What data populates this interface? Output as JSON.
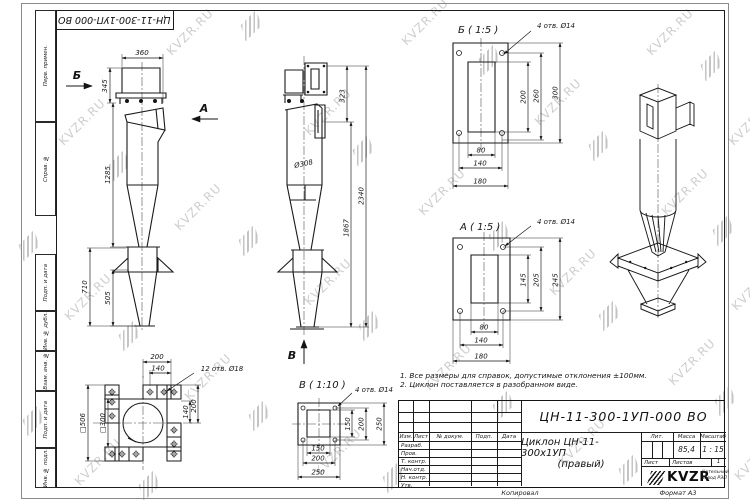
{
  "watermark": {
    "text": "KVZR.RU"
  },
  "sheet": {
    "top_doc_number": "ЦН-11-300-1УП-000 ВО",
    "margin_labels": [
      "Перв. примен.",
      "Справ. №",
      "Подп. и дата",
      "Инв. № дубл.",
      "Взам. инв. №",
      "Подп. и дата",
      "Инв. № подл."
    ]
  },
  "views": {
    "front": {
      "arrow_b": "Б",
      "arrow_a": "А",
      "dims": {
        "top_width": "360",
        "inlet_height": "345",
        "body_height": "1285",
        "bunker_height": "710",
        "cone_height": "505"
      }
    },
    "side": {
      "arrow_v": "В",
      "dims": {
        "flange_offset": "323",
        "total_height": "2340",
        "lower_height": "1867",
        "body_diameter": "Ø308"
      }
    },
    "detail_b": {
      "title": "Б ( 1:5 )",
      "holes": "4 отв. Ø14",
      "dims": {
        "v1": "200",
        "v2": "260",
        "v3": "300",
        "h1": "80",
        "h2": "140",
        "h3": "180"
      }
    },
    "detail_a": {
      "title": "А ( 1:5 )",
      "holes": "4 отв. Ø14",
      "dims": {
        "v1": "145",
        "v2": "205",
        "v3": "245",
        "h1": "80",
        "h2": "140",
        "h3": "180"
      }
    },
    "detail_v": {
      "title": "В ( 1:10 )",
      "holes": "4 отв. Ø14",
      "dims": {
        "v1": "150",
        "v2": "200",
        "v3": "250",
        "h1": "150",
        "h2": "200",
        "h3": "250"
      }
    },
    "support": {
      "holes": "12 отв. Ø18",
      "dims": {
        "t1": "200",
        "t2": "140",
        "l1": "□506",
        "l2": "□300",
        "r1": "140",
        "r2": "200"
      }
    }
  },
  "notes": {
    "line1": "1. Все размеры для справок, допустимые отклонения ±100мм.",
    "line2": "2. Циклон поставляется в разобранном виде."
  },
  "title_block": {
    "doc_number": "ЦН-11-300-1УП-000 ВО",
    "product_title": "Циклон ЦН-11-300х1УП",
    "product_subtitle": "(правый)",
    "col_izm": "Изм.",
    "col_list": "Лист",
    "col_doc": "№ докум.",
    "col_podp": "Подп.",
    "col_data": "Дата",
    "row_razrab": "Разраб.",
    "row_prov": "Пров.",
    "row_tkontr": "Т. контр.",
    "row_nachotd": "Нач.отд.",
    "row_nkontr": "Н. контр.",
    "row_utv": "Утв.",
    "lit_label": "Лит.",
    "mass_label": "Масса",
    "scale_label": "Масштаб",
    "mass_value": "85,4",
    "scale_value": "1 : 15",
    "sheet_label": "Лист",
    "sheets_label": "Листов",
    "sheets_value": "1",
    "logo_text": "KVZR",
    "company_line1": "Котельный",
    "company_line2": "завод РЭП",
    "footer_copy": "Копировал",
    "footer_format": "Формат А3"
  }
}
